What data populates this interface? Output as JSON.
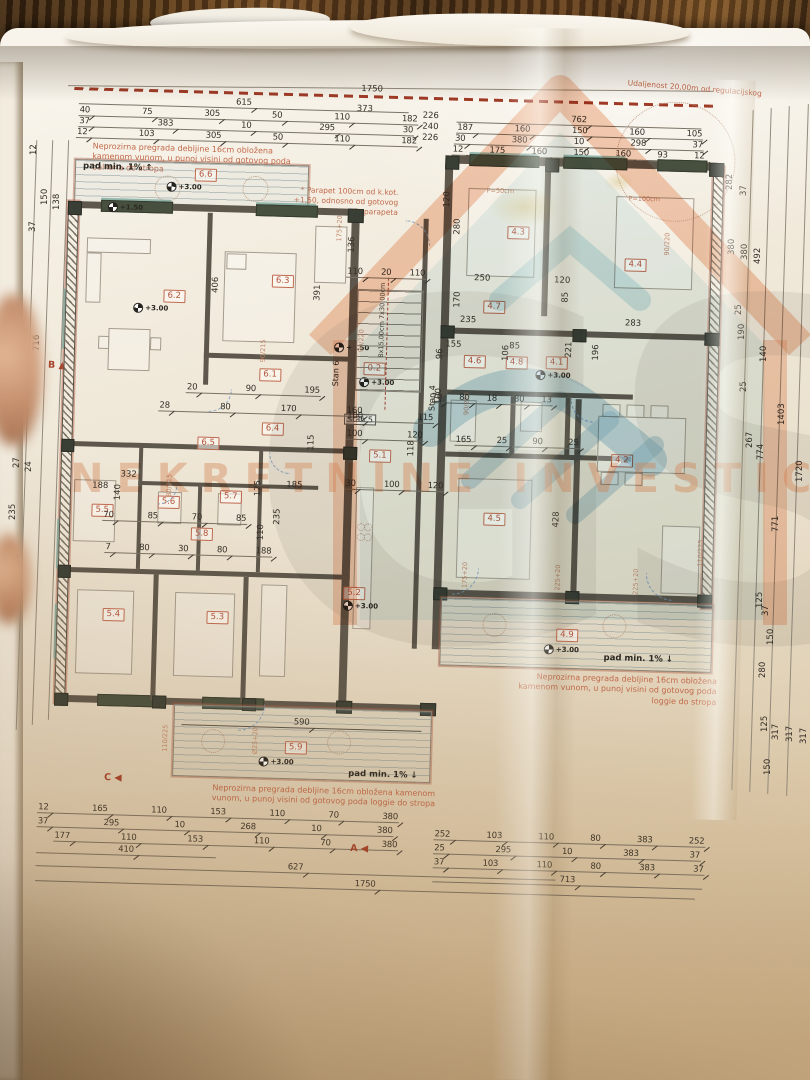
{
  "notes": {
    "regulation": "Udaljenost 20,00m od regulacijskog",
    "partition_balcony": "Neprozirna pregrada debljine 16cm obložena kamenom vunom, u punoj visini od gotovog poda balkona do stropa",
    "partition_loggia": "Neprozirna pregrada debljine 16cm obložena kamenom vunom, u punoj visini od gotovog poda loggie do stropa",
    "parapet": "* Parapet 100cm od k.kot. +1,50, odnosno od gotovog poda parapeta",
    "slope": "pad min. 1%",
    "stairs": "8x15,00cm  7x30,00cm"
  },
  "markers": {
    "a": "A",
    "b": "B",
    "c": "C",
    "d1": "D1",
    "elev300": "+3.00",
    "elev150": "+1.50",
    "arrow_up": "↑",
    "arrow_down": "↓"
  },
  "apartments": [
    "Stan 4",
    "Stan 5",
    "Stan 6"
  ],
  "rooms": [
    "6.6",
    "6.2",
    "6.3",
    "6.1",
    "6.4",
    "6.5",
    "0.2",
    "5.5",
    "5.6",
    "5.7",
    "5.8",
    "5.4",
    "5.3",
    "5.1",
    "5.2",
    "5.9",
    "4.3",
    "4.4",
    "4.7",
    "4.6",
    "4.8",
    "4.1",
    "4.5",
    "4.2",
    "4.9"
  ],
  "door_labels": [
    "90/215",
    "80/215",
    "90/220",
    "110/225",
    "225+20",
    "175+20",
    "Ø25+20",
    "P=50cm",
    "P=100cm"
  ],
  "watermark": {
    "brand": "NEKRETNINE INVESTICIJE",
    "monogram": "GS"
  },
  "dims": {
    "tl_total": "615",
    "tl_grand": "1750",
    "tl_373": "373",
    "tl_r1": [
      "40",
      "75",
      "305",
      "50",
      "110",
      "182"
    ],
    "tl_r2": [
      "37",
      "383",
      "10",
      "295",
      "30"
    ],
    "tl_r3": [
      "12",
      "103",
      "305",
      "50",
      "110",
      "182"
    ],
    "mid_col": [
      "226",
      "240",
      "226"
    ],
    "tr_total": "762",
    "tr_r1": [
      "187",
      "160",
      "150",
      "160",
      "105"
    ],
    "tr_r2": [
      "30",
      "380",
      "10",
      "298",
      "37"
    ],
    "tr_r3": [
      "12",
      "175",
      "160",
      "150",
      "160",
      "93",
      "12"
    ],
    "bl_r1": [
      "12",
      "165",
      "110",
      "153",
      "110",
      "70",
      "380"
    ],
    "bl_r2": [
      "37",
      "295",
      "10",
      "268",
      "10",
      "380"
    ],
    "bl_r3": [
      "177",
      "110",
      "153",
      "110",
      "70",
      "380"
    ],
    "bl_410": "410",
    "bl_627": "627",
    "bl_1750": "1750",
    "br_r1": [
      "252",
      "103",
      "110",
      "80",
      "383",
      "252"
    ],
    "br_r2": [
      "25",
      "295",
      "10",
      "383",
      "37"
    ],
    "br_r3": [
      "37",
      "103",
      "110",
      "80",
      "383",
      "37"
    ],
    "br_713": "713",
    "left_chain": [
      "12",
      "150",
      "138",
      "37",
      "716",
      "716",
      "27",
      "24",
      "235",
      "10",
      "605"
    ],
    "right_chain": [
      "282",
      "37",
      "380",
      "380",
      "492",
      "25",
      "190",
      "140",
      "25",
      "267",
      "774",
      "1403",
      "1720",
      "771",
      "125",
      "37",
      "150",
      "280",
      "125",
      "317",
      "317",
      "317",
      "150"
    ],
    "q1": [
      "20",
      "90",
      "195"
    ],
    "q2": [
      "28",
      "80",
      "170",
      "160"
    ],
    "q3": [
      "70",
      "85",
      "70",
      "85"
    ],
    "q4": [
      "7",
      "80",
      "30",
      "80",
      "188"
    ],
    "q5": [
      "70",
      "80",
      "18",
      "80",
      "13"
    ],
    "q6": [
      "165",
      "25",
      "90",
      "25"
    ],
    "q7": [
      "110",
      "20",
      "110"
    ],
    "q8": [
      "100",
      "120"
    ],
    "q9": [
      "30",
      "100",
      "120"
    ],
    "q10": [
      "100",
      "115"
    ],
    "single_590": "590",
    "plan": [
      "406",
      "391",
      "428",
      "221",
      "196",
      "283",
      "250",
      "120",
      "170",
      "85",
      "235",
      "155",
      "85",
      "106",
      "96",
      "100",
      "590",
      "332",
      "185",
      "118",
      "110",
      "188",
      "140",
      "125",
      "136",
      "280",
      "115",
      "235",
      "120",
      "100"
    ]
  }
}
